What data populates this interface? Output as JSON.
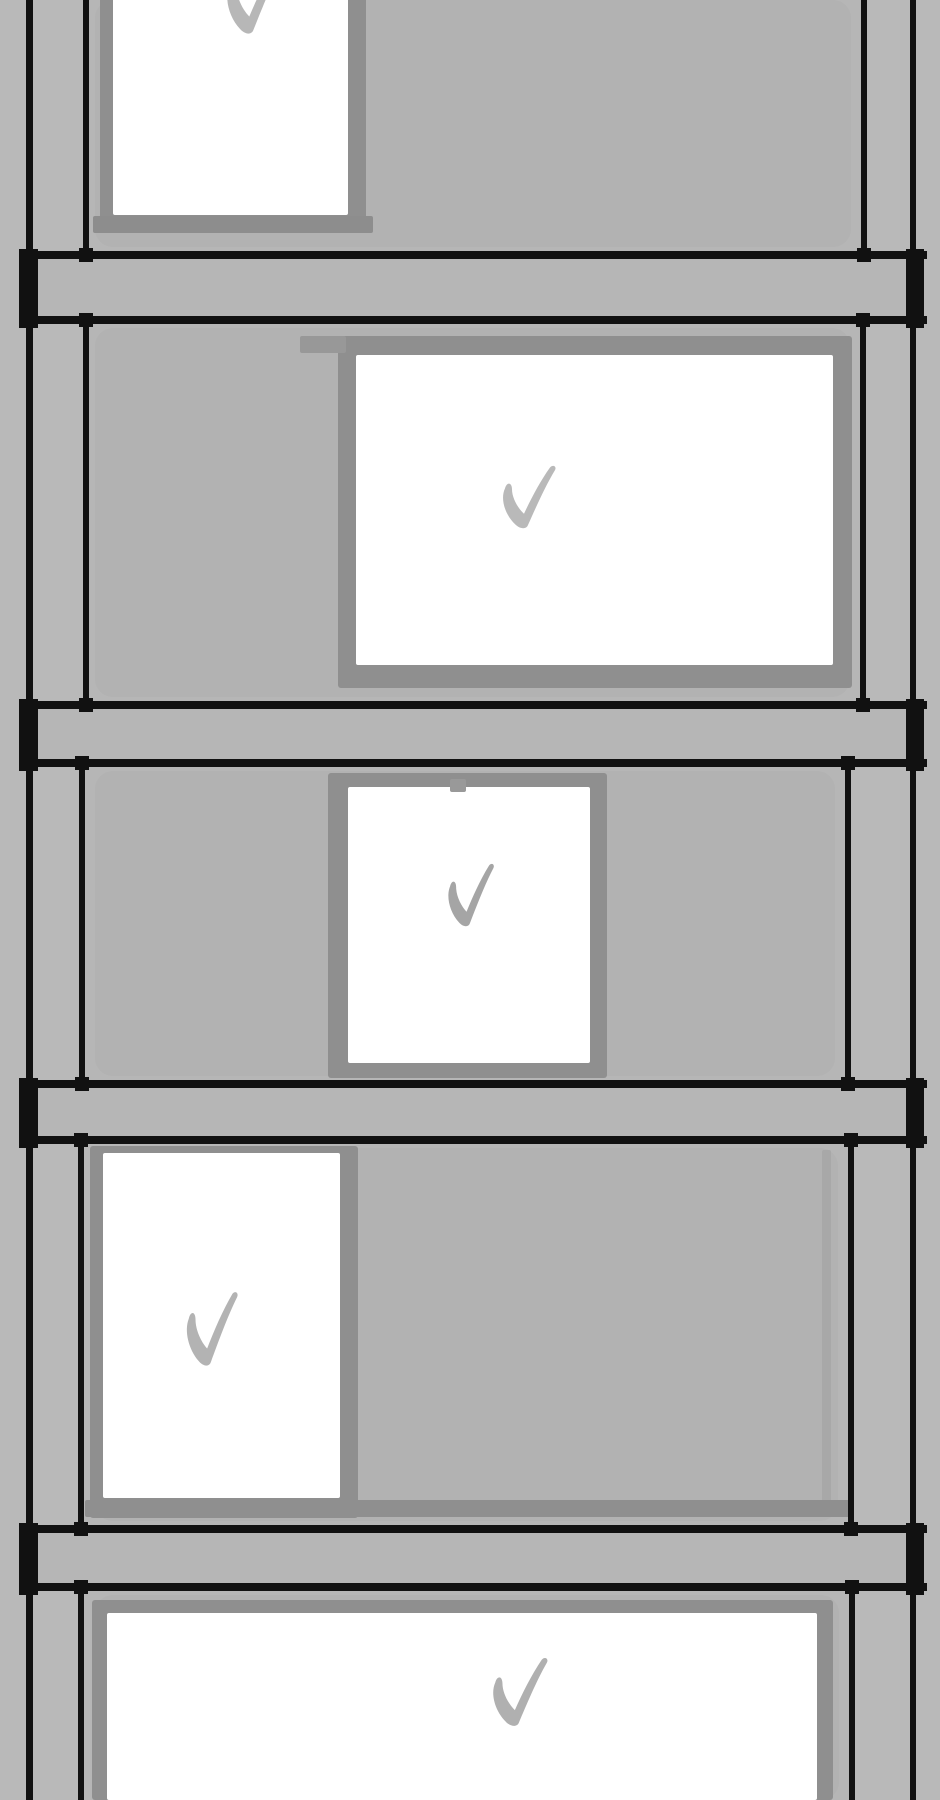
{
  "scene": {
    "description": "Hand-drawn sketch of a five-story building facade; each floor section holds a white window box containing a gray hand-painted checkmark",
    "floors_total": 5,
    "all_checked": true,
    "canvas": {
      "width": 940,
      "height": 1800
    }
  },
  "colors": {
    "background": "#b9b9b9",
    "wall": "#b6b6b6",
    "wall_shade": "#b2b2b2",
    "line": "#111111",
    "window_frame": "#8f8f8f",
    "window_glass": "#ffffff"
  },
  "geometry": {
    "columns": {
      "left_outer": {
        "x": 26,
        "w": 7
      },
      "right_outer": {
        "x": 910,
        "w": 6
      }
    },
    "slabs": [
      {
        "name": "slab-1",
        "y1": 251,
        "y2": 316,
        "line_h": 8,
        "x1": 19,
        "x2": 927
      },
      {
        "name": "slab-2",
        "y1": 701,
        "y2": 759,
        "line_h": 8,
        "x1": 19,
        "x2": 927
      },
      {
        "name": "slab-3",
        "y1": 1080,
        "y2": 1136,
        "line_h": 8,
        "x1": 19,
        "x2": 927
      },
      {
        "name": "slab-4",
        "y1": 1525,
        "y2": 1583,
        "line_h": 8,
        "x1": 19,
        "x2": 927
      }
    ],
    "floors": [
      {
        "name": "floor-1",
        "top": 0,
        "bottom": 259,
        "left_inner_x": 83,
        "right_inner_x": 861,
        "checked": true,
        "window": {
          "x": 100,
          "y": -24,
          "w": 266,
          "h": 257,
          "frame": {
            "l": 13,
            "t": 0,
            "r": 18,
            "b": 18
          }
        },
        "check": {
          "x": 222,
          "y": -42,
          "w": 63,
          "h": 80,
          "color": "#b7b7b7"
        }
      },
      {
        "name": "floor-2",
        "top": 316,
        "bottom": 709,
        "left_inner_x": 83,
        "right_inner_x": 860,
        "checked": true,
        "window": {
          "x": 338,
          "y": 336,
          "w": 514,
          "h": 352,
          "frame": {
            "l": 18,
            "t": 19,
            "r": 19,
            "b": 23
          }
        },
        "check": {
          "x": 498,
          "y": 464,
          "w": 60,
          "h": 68,
          "color": "#b9b9b9"
        }
      },
      {
        "name": "floor-3",
        "top": 759,
        "bottom": 1088,
        "left_inner_x": 79,
        "right_inner_x": 845,
        "checked": true,
        "window": {
          "x": 328,
          "y": 773,
          "w": 279,
          "h": 305,
          "frame": {
            "l": 20,
            "t": 14,
            "r": 17,
            "b": 15
          }
        },
        "check": {
          "x": 444,
          "y": 862,
          "w": 52,
          "h": 68,
          "color": "#a5a5a5"
        }
      },
      {
        "name": "floor-4",
        "top": 1136,
        "bottom": 1533,
        "left_inner_x": 78,
        "right_inner_x": 848,
        "checked": true,
        "window": {
          "x": 90,
          "y": 1146,
          "w": 268,
          "h": 372,
          "frame": {
            "l": 13,
            "t": 7,
            "r": 18,
            "b": 20
          }
        },
        "check": {
          "x": 182,
          "y": 1290,
          "w": 58,
          "h": 80,
          "color": "#b3b3b3"
        }
      },
      {
        "name": "floor-5",
        "top": 1583,
        "bottom": 1800,
        "left_inner_x": 78,
        "right_inner_x": 849,
        "checked": true,
        "window": {
          "x": 92,
          "y": 1600,
          "w": 741,
          "h": 200,
          "frame": {
            "l": 15,
            "t": 13,
            "r": 16,
            "b": 0
          }
        },
        "check": {
          "x": 488,
          "y": 1656,
          "w": 62,
          "h": 74,
          "color": "#b0b0b0"
        }
      }
    ],
    "details": [
      {
        "name": "window-sill-band-floor-1",
        "x": 93,
        "y": 216,
        "w": 280,
        "h": 17,
        "color": "#8d8d8d"
      },
      {
        "name": "frame-overshoot-floor-2",
        "x": 300,
        "y": 336,
        "w": 46,
        "h": 17,
        "color": "#989898"
      },
      {
        "name": "frame-tick-floor-3",
        "x": 450,
        "y": 779,
        "w": 16,
        "h": 13,
        "color": "#999999"
      },
      {
        "name": "wall-seam-line-floor-4",
        "x": 822,
        "y": 1150,
        "w": 9,
        "h": 352,
        "color": "#a8a8a8"
      },
      {
        "name": "window-sill-band-floor-4",
        "x": 85,
        "y": 1500,
        "w": 767,
        "h": 17,
        "color": "#8f8f8f"
      }
    ],
    "check_path": "M7,28 C2,40 7,58 17,69 C21,74 28,76 30,70 C37,52 47,26 57,7 C59,3 55,0 52,4 C42,20 33,40 26,57 C20,51 14,39 14,29 C14,21 9,20 7,28 Z"
  }
}
